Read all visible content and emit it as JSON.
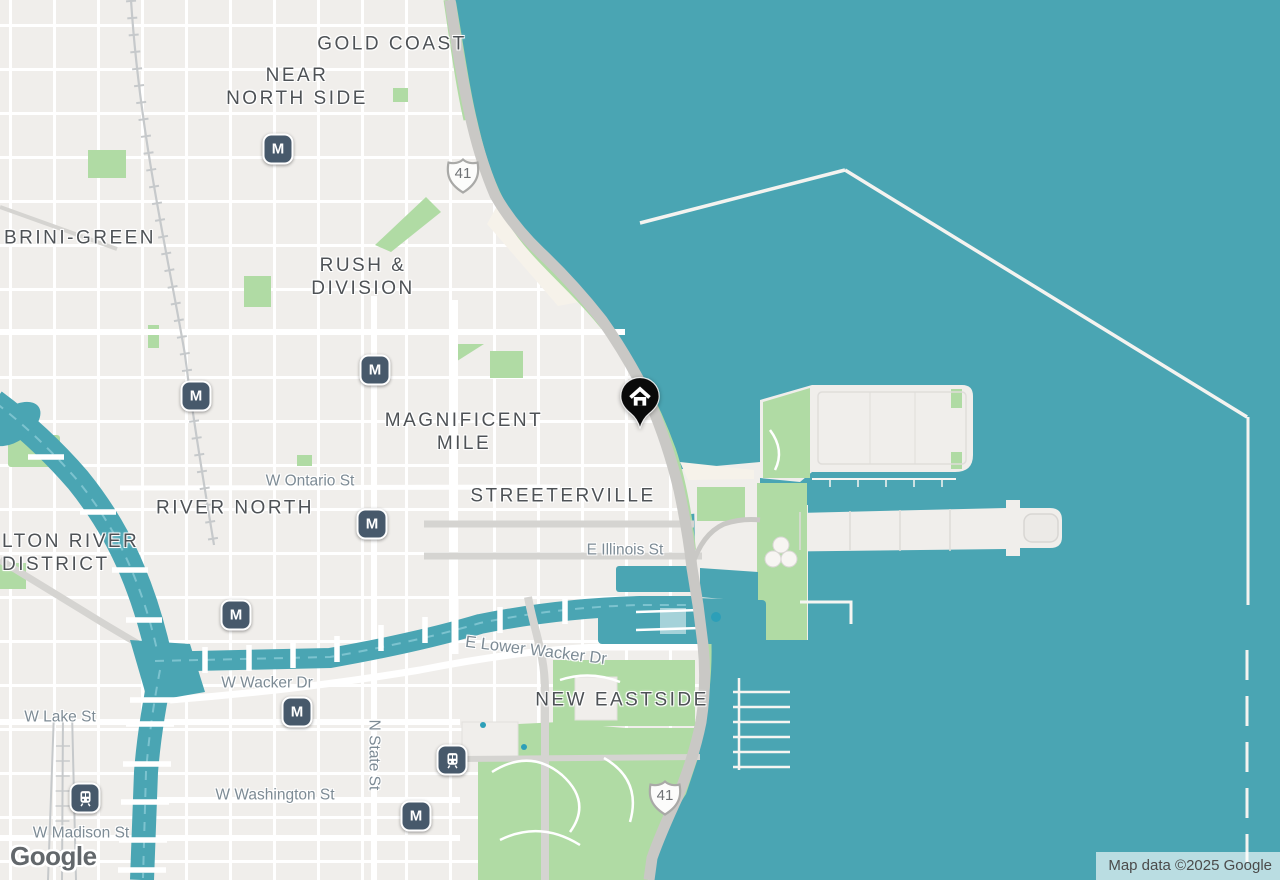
{
  "map": {
    "attribution": "Map data ©2025 Google",
    "logo": "Google",
    "marker": {
      "type": "home-pin"
    },
    "transit": {
      "metro": "M"
    },
    "route_shields": [
      {
        "number": "41"
      },
      {
        "number": "41"
      }
    ],
    "neighborhoods": [
      {
        "text": "GOLD COAST"
      },
      {
        "text": "NEAR\nNORTH SIDE"
      },
      {
        "text": "BRINI-GREEN"
      },
      {
        "text": "RUSH &\nDIVISION"
      },
      {
        "text": "MAGNIFICENT\nMILE"
      },
      {
        "text": "RIVER NORTH"
      },
      {
        "text": "LTON RIVER\nDISTRICT"
      },
      {
        "text": "STREETERVILLE"
      },
      {
        "text": "NEW EASTSIDE"
      }
    ],
    "streets": [
      {
        "text": "W Ontario St"
      },
      {
        "text": "E Illinois St"
      },
      {
        "text": "E Lower Wacker Dr"
      },
      {
        "text": "W Wacker Dr"
      },
      {
        "text": "W Lake St"
      },
      {
        "text": "N State St"
      },
      {
        "text": "W Washington St"
      },
      {
        "text": "W Madison St"
      }
    ],
    "colors": {
      "water": "#4AA5B3",
      "land": "#F0EEEB",
      "park": "#B0DBA4",
      "road_major": "#C9C8C5",
      "transit_bg": "#47596B",
      "marker": "#0A0A0A",
      "nb_text": "#4E5256",
      "st_text": "#7D8B95"
    }
  }
}
